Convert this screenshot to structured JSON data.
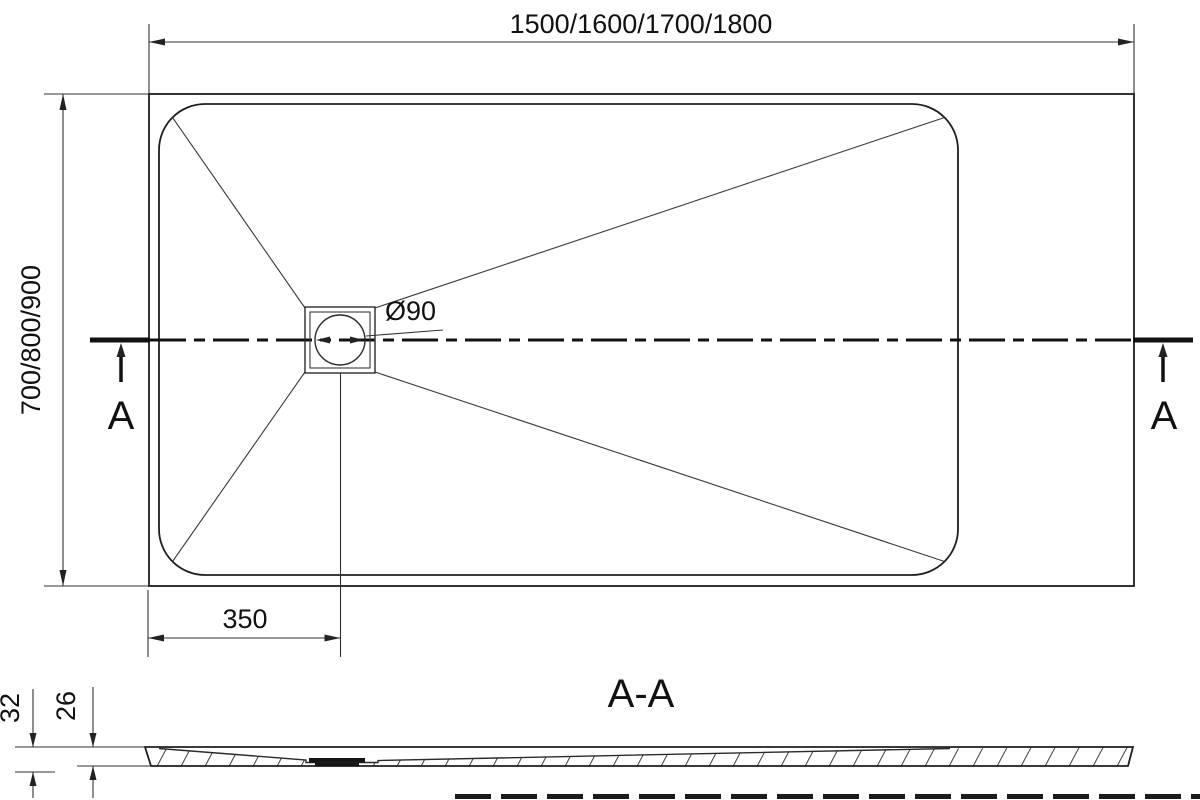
{
  "plan": {
    "length_dim": "1500/1600/1700/1800",
    "width_dim": "700/800/900",
    "drain_offset_dim": "350",
    "drain_diameter_label": "Ø90",
    "section_marker_left": "A",
    "section_marker_right": "A"
  },
  "section": {
    "title": "A-A",
    "overall_height_dim": "32",
    "tray_height_dim": "26"
  },
  "colors": {
    "line": "#1e1e1e",
    "background": "#ffffff"
  }
}
